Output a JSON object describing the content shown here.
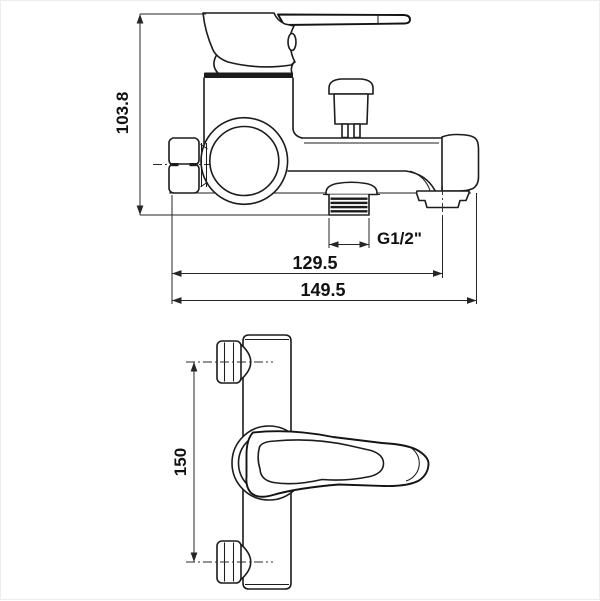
{
  "drawing": {
    "background": "#ffffff",
    "line_color": "#1c1c1c",
    "views": {
      "side": {
        "name": "side-view",
        "dims": {
          "height": {
            "label": "103.8",
            "orientation": "vertical"
          },
          "outlet_thread": {
            "label": "G1/2\"",
            "orientation": "horizontal"
          },
          "spout_center": {
            "label": "129.5",
            "orientation": "horizontal"
          },
          "total_length": {
            "label": "149.5",
            "orientation": "horizontal"
          }
        }
      },
      "front": {
        "name": "front-view",
        "dims": {
          "mount_distance": {
            "label": "150",
            "orientation": "vertical"
          }
        }
      }
    }
  }
}
